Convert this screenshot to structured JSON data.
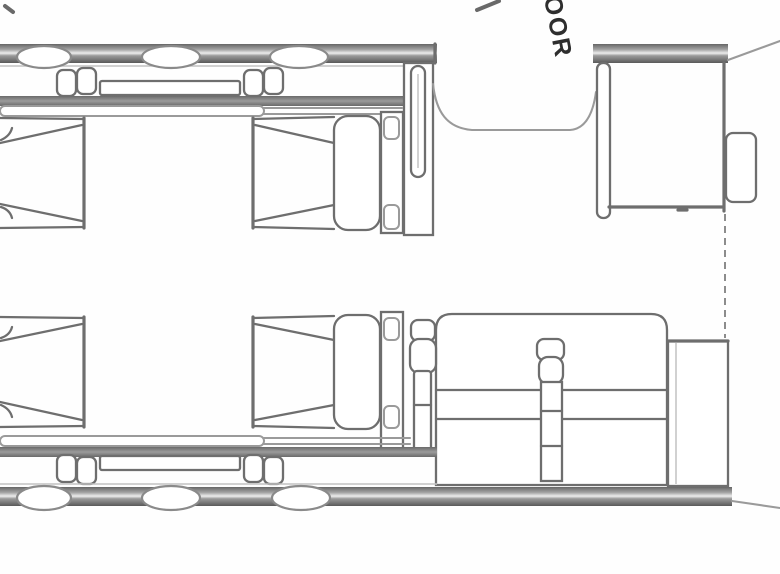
{
  "floorplan": {
    "door_label": "DOOR",
    "colors": {
      "line": "#6e6e6e",
      "line-dark": "#4f4f4f",
      "soft": "#9a9a9a",
      "faint": "#c2c2c2",
      "text": "#2e2e2e",
      "bg": "#fefefe"
    }
  }
}
